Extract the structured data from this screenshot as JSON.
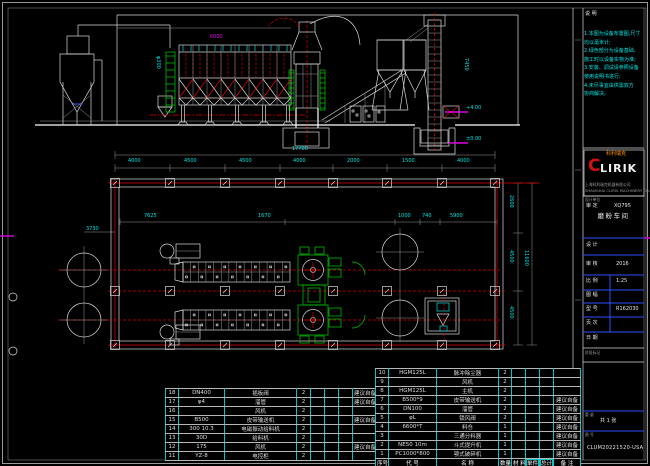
{
  "notes": {
    "lines": [
      "1.本图为设备布置图,尺寸",
      "  均以毫米计;",
      "2.绿色部分为设备基础,",
      "  施工时以设备实物为准;",
      "3.安装、调试请参照设备",
      "  使用说明书进行;",
      "4.未尽事宜由供需双方",
      "  协商解决。"
    ]
  },
  "logo": {
    "brand_cn": "科利瑞克",
    "brand_c": "C",
    "brand_rest": "LIRIK",
    "company_cn": "上海科利瑞克机器有限公司",
    "company_en": "SHANGHAI CLIRIK MACHINERY CO.,LTD"
  },
  "title_block": {
    "top_label": "说 明",
    "org_label": "设计单位",
    "approve_left": "审 定",
    "approve_right": "XQ795",
    "drawing_title": "磨粉车间",
    "rows": [
      {
        "label": "设 计",
        "value": ""
      },
      {
        "label": "审 核",
        "value": "2016"
      },
      {
        "label": "比 例",
        "value": "1:25"
      },
      {
        "label": "图 幅",
        "value": ""
      },
      {
        "label": "型 号",
        "value": "R162030"
      },
      {
        "label": "页 次",
        "value": ""
      },
      {
        "label": "日 期",
        "value": ""
      }
    ],
    "stage_label": "阶段标记",
    "weight_label": "重 量",
    "sheet_info": "共 1 张",
    "no_label": "图 号",
    "drawing_no": "CLUM20221520-USA"
  },
  "plan": {
    "total_width": "17700",
    "bay_dims": [
      "4000",
      "4500",
      "4500",
      "4000",
      "2000",
      "1500",
      "4000"
    ],
    "inner_dims": [
      "7625",
      "1670",
      "1000",
      "740",
      "5900"
    ],
    "right_dims": [
      "2600",
      "4500",
      "4500"
    ],
    "right_total": "11600",
    "left_dim": "3730"
  },
  "elevation": {
    "labels": {
      "baghouse_dim": "6000",
      "duct_dim": "φ300",
      "elevator_dim": "7450",
      "inlet_level": "+4.00",
      "ground_level": "±0.00"
    }
  },
  "bom": {
    "headers": [
      "序号",
      "代 号",
      "名 称",
      "数量",
      "材 料",
      "单件",
      "总计",
      "备 注"
    ],
    "left_rows": [
      [
        "18",
        "DN400",
        "插板阀",
        "2",
        "",
        "",
        "",
        "建议自备"
      ],
      [
        "17",
        "φ4",
        "溜管",
        "2",
        "",
        "",
        "",
        "建议自备"
      ],
      [
        "16",
        "",
        "风机",
        "2",
        "",
        "",
        "",
        ""
      ],
      [
        "15",
        "B500",
        "皮带输送机",
        "2",
        "",
        "",
        "",
        "建议自备"
      ],
      [
        "14",
        "300 10.3",
        "电磁振动给料机",
        "2",
        "",
        "",
        "",
        ""
      ],
      [
        "13",
        "30D",
        "给料机",
        "2",
        "",
        "",
        "",
        ""
      ],
      [
        "12",
        "175",
        "风机",
        "2",
        "",
        "",
        "",
        "建议自备"
      ],
      [
        "11",
        "YZ-8",
        "电控柜",
        "2",
        "",
        "",
        "",
        ""
      ]
    ],
    "right_rows": [
      [
        "10",
        "HGM125L",
        "脉冲除尘器",
        "2",
        "",
        "",
        "",
        ""
      ],
      [
        "9",
        "",
        "风机",
        "2",
        "",
        "",
        "",
        ""
      ],
      [
        "8",
        "HGM125L",
        "主机",
        "2",
        "",
        "",
        "",
        ""
      ],
      [
        "7",
        "B500*9",
        "皮带输送机",
        "2",
        "",
        "",
        "",
        "建议自备"
      ],
      [
        "6",
        "DN100",
        "溜管",
        "2",
        "",
        "",
        "",
        "建议自备"
      ],
      [
        "5",
        "φL",
        "锁风阀",
        "2",
        "",
        "",
        "",
        "建议自备"
      ],
      [
        "4",
        "6600*T",
        "料仓",
        "1",
        "",
        "",
        "",
        "建议自备"
      ],
      [
        "3",
        "",
        "三通分料器",
        "1",
        "",
        "",
        "",
        "建议自备"
      ],
      [
        "2",
        "NE50 10m",
        "斗式提升机",
        "1",
        "",
        "",
        "",
        "建议自备"
      ],
      [
        "1",
        "PC1000*800",
        "颚式破碎机",
        "1",
        "",
        "",
        "",
        "建议自备"
      ]
    ]
  }
}
